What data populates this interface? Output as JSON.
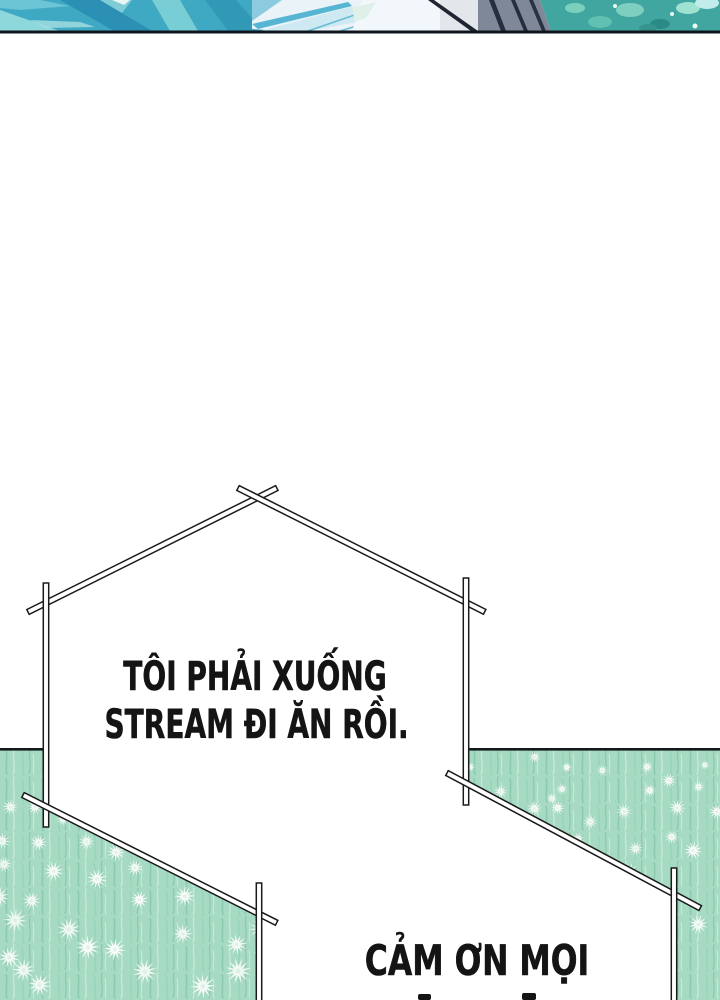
{
  "page": {
    "width": 720,
    "height": 1000,
    "background": "#ffffff"
  },
  "top_panel": {
    "description": "bottom sliver of previous comic panel",
    "palette": {
      "teal": "#3fa9c4",
      "aqua_light": "#8ed7da",
      "teal_dark": "#2c8fb4",
      "glass_blue": "#cfe9f3",
      "glass_white": "#f1f7fa",
      "slate": "#7e8899",
      "navy_stripe": "#262d3d",
      "foliage_teal": "#41a69f",
      "border": "#0f151d"
    }
  },
  "field": {
    "base": "#a7dac2",
    "grass_dark": "#8ccab0",
    "grass_light": "#c4ead6",
    "flower": "#fbfdfc",
    "horizon": "#121a1c"
  },
  "bubbles": [
    {
      "id": "bubble-1",
      "lines": [
        "TÔI PHẢI XUỐNG",
        "STREAM ĐI ĂN RỒI."
      ]
    },
    {
      "id": "bubble-2",
      "lines": [
        "CẢM ƠN MỌI"
      ]
    }
  ],
  "text_color": "#141414",
  "outline_color": "#1a1a1a"
}
